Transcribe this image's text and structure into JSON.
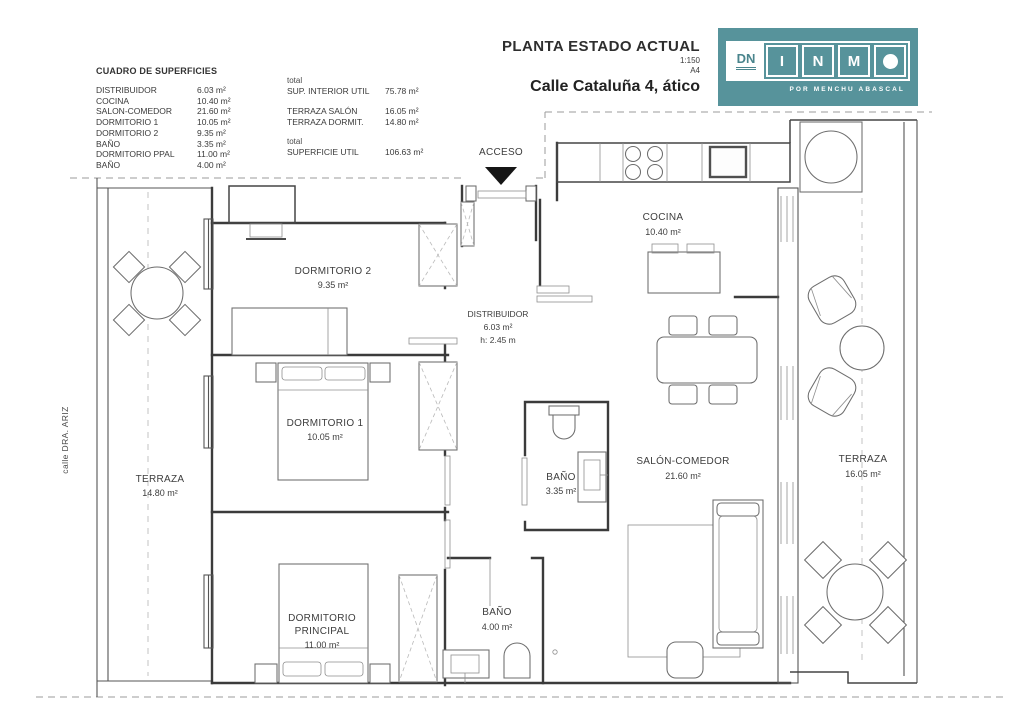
{
  "header": {
    "title": "PLANTA ESTADO ACTUAL",
    "scale": "1:150",
    "sheet": "A4",
    "subtitle": "Calle Cataluña 4, ático",
    "logo": {
      "dn": "DN",
      "letters": [
        "I",
        "N",
        "M"
      ],
      "tagline": "POR MENCHU ABASCAL",
      "teal": "#57939b"
    }
  },
  "surface_table": {
    "title": "CUADRO DE SUPERFICIES",
    "rooms": [
      {
        "label": "DISTRIBUIDOR",
        "value": "6.03 m²"
      },
      {
        "label": "COCINA",
        "value": "10.40 m²"
      },
      {
        "label": "SALON-COMEDOR",
        "value": "21.60 m²"
      },
      {
        "label": "DORMITORIO 1",
        "value": "10.05 m²"
      },
      {
        "label": "DORMITORIO 2",
        "value": "9.35 m²"
      },
      {
        "label": "BAÑO",
        "value": "3.35 m²"
      },
      {
        "label": "DORMITORIO PPAL",
        "value": "11.00 m²"
      },
      {
        "label": "BAÑO",
        "value": "4.00 m²"
      }
    ],
    "totals": {
      "pre1": "total",
      "interior_label": "SUP. INTERIOR UTIL",
      "interior_value": "75.78 m²",
      "terraza_salon_label": "TERRAZA SALÓN",
      "terraza_salon_value": "16.05 m²",
      "terraza_dormit_label": "TERRAZA DORMIT.",
      "terraza_dormit_value": "14.80 m²",
      "pre2": "total",
      "util_label": "SUPERFICIE UTIL",
      "util_value": "106.63 m²"
    }
  },
  "plan": {
    "acceso": "ACCESO",
    "street": "calle DRA. ARIZ",
    "rooms": {
      "dormitorio2": {
        "name": "DORMITORIO 2",
        "area": "9.35 m²"
      },
      "dormitorio1": {
        "name": "DORMITORIO 1",
        "area": "10.05 m²"
      },
      "principal": {
        "name1": "DORMITORIO",
        "name2": "PRINCIPAL",
        "area": "11.00 m²"
      },
      "bano1": {
        "name": "BAÑO",
        "area": "3.35 m²"
      },
      "bano2": {
        "name": "BAÑO",
        "area": "4.00 m²"
      },
      "distribuidor": {
        "name": "DISTRIBUIDOR",
        "area": "6.03 m²",
        "height": "h: 2.45 m"
      },
      "cocina": {
        "name": "COCINA",
        "area": "10.40 m²"
      },
      "salon": {
        "name": "SALÓN-COMEDOR",
        "area": "21.60 m²"
      },
      "terraza_dorm": {
        "name": "TERRAZA",
        "area": "14.80 m²"
      },
      "terraza_salon": {
        "name": "TERRAZA",
        "area": "16.05 m²"
      }
    }
  }
}
